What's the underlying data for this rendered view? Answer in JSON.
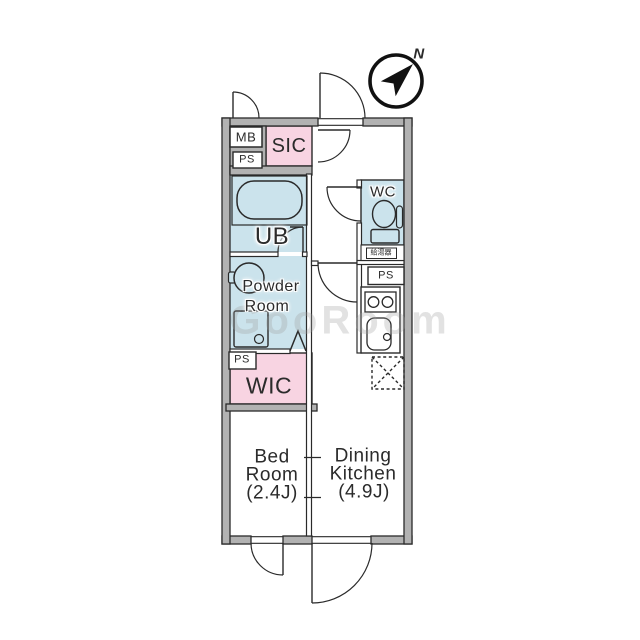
{
  "compass": {
    "north": "N"
  },
  "watermark": "GooRoom",
  "boxes": {
    "mb": "MB",
    "ps": "PS",
    "water_heater": "給湯器"
  },
  "rooms": {
    "sic": "SIC",
    "unit_bath": "UB",
    "wc": "WC",
    "powder_line1": "Powder",
    "powder_line2": "Room",
    "wic": "WIC",
    "bed_line1": "Bed",
    "bed_line2": "Room",
    "bed_size": "(2.4J)",
    "dk_line1": "Dining",
    "dk_line2": "Kitchen",
    "dk_size": "(4.9J)"
  },
  "colors": {
    "wall": "#b2b2b2",
    "wet": "#cbe3ec",
    "closet": "#f8d4e2",
    "line": "#2a2a2a",
    "text": "#2b2b2b",
    "watermark": "#a0a0a0"
  }
}
